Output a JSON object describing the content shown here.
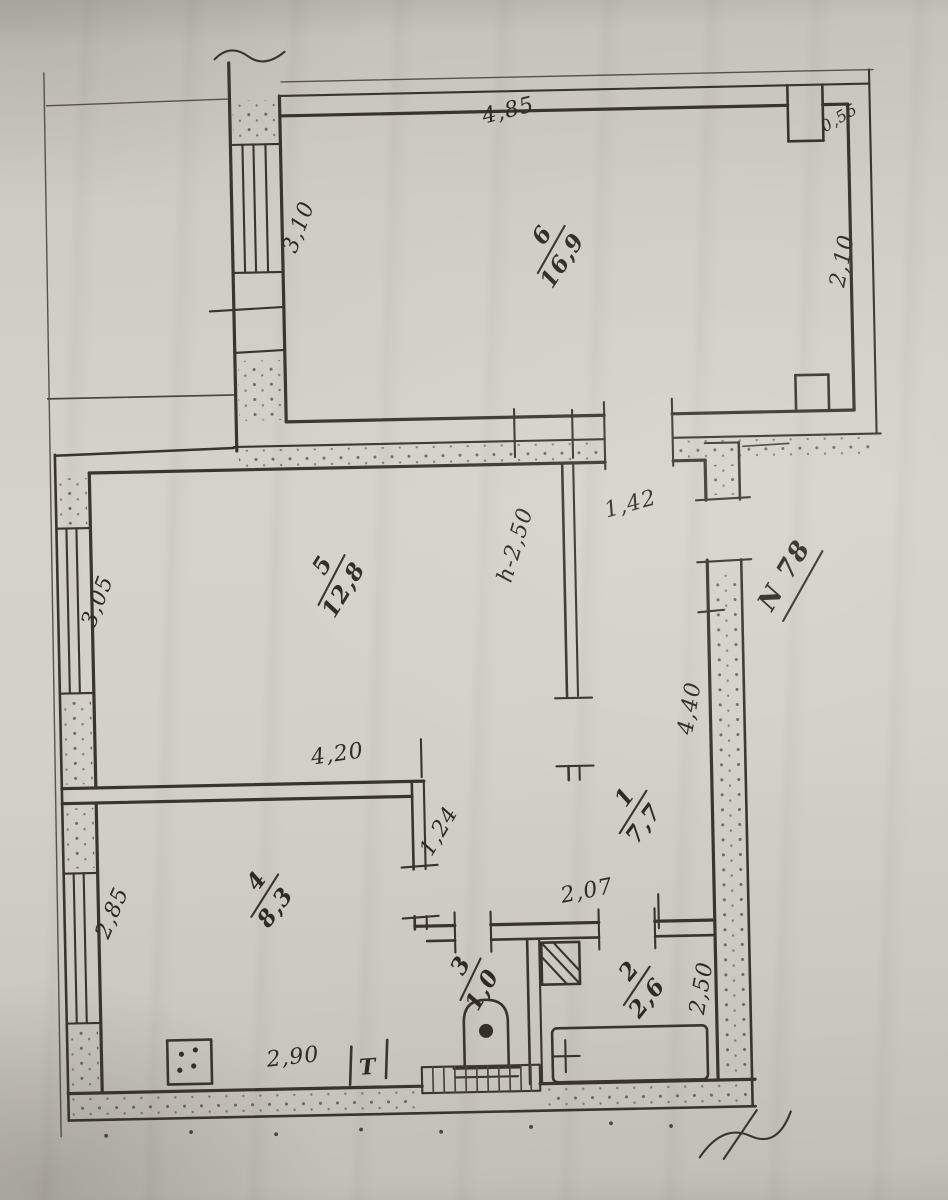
{
  "plan": {
    "apartment_label": "N 78",
    "ceiling_height_note": "h-2,50",
    "rooms": [
      {
        "number": "6",
        "area": "16,9"
      },
      {
        "number": "5",
        "area": "12,8"
      },
      {
        "number": "4",
        "area": "8,3"
      },
      {
        "number": "3",
        "area": "1,0"
      },
      {
        "number": "2",
        "area": "2,6"
      },
      {
        "number": "1",
        "area": "7,7"
      }
    ],
    "dimensions": {
      "room6_width_top": "4,85",
      "room6_depth_left": "3,10",
      "room6_depth_right": "2,10",
      "room6_niche": "0,55",
      "room5_window_side": "3,05",
      "room5_width_bottom": "4,20",
      "hall_entry_width": "1,42",
      "hall_length": "4,40",
      "room4_window_side": "2,85",
      "room4_width_bottom": "2,90",
      "passage_width": "1,24",
      "bath_passage_width": "2,07",
      "bath_length": "2,50"
    },
    "fixtures": {
      "towel_rail_label": "Т"
    }
  }
}
